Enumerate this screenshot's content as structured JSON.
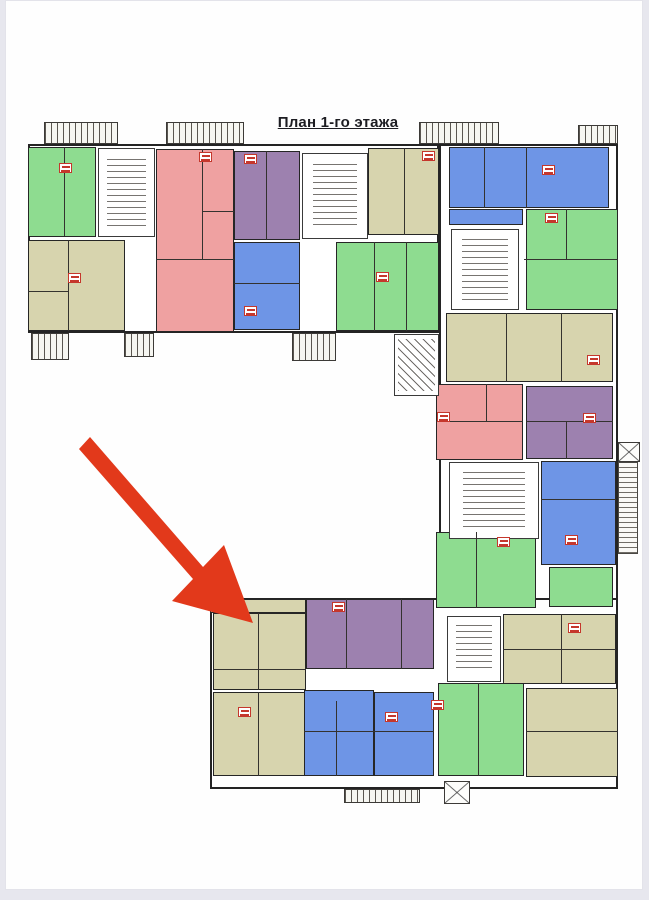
{
  "page": {
    "title": "План 1-го этажа",
    "background": "#fefefe",
    "frame_color": "#e7e7ee"
  },
  "palette": {
    "wall": "#242424",
    "green": "#8edc90",
    "pink": "#efa1a1",
    "purple": "#9d81af",
    "blue": "#6e95e6",
    "olive": "#d7d4ae",
    "arrow": "#e2391b",
    "badge_border": "#c5372c"
  },
  "arrow": {
    "points": "84,436 197,566 218,544 247,622 166,600 187,578 73,448"
  },
  "outlines": [
    {
      "name": "top-wing-outline",
      "x": 22,
      "y": 143,
      "w": 411,
      "h": 189
    },
    {
      "name": "right-wing-outline",
      "x": 433,
      "y": 143,
      "w": 179,
      "h": 469
    },
    {
      "name": "bottom-wing-outline",
      "x": 204,
      "y": 597,
      "w": 408,
      "h": 191
    }
  ],
  "balconies": [
    {
      "name": "balcony-top-1",
      "x": 38,
      "y": 121,
      "w": 74,
      "h": 22,
      "variant": "ladder"
    },
    {
      "name": "balcony-top-2",
      "x": 160,
      "y": 121,
      "w": 78,
      "h": 22,
      "variant": "ladder"
    },
    {
      "name": "balcony-top-3",
      "x": 413,
      "y": 121,
      "w": 80,
      "h": 22,
      "variant": "ladder"
    },
    {
      "name": "balcony-top-4",
      "x": 572,
      "y": 124,
      "w": 40,
      "h": 19,
      "variant": "ladder"
    },
    {
      "name": "entry-stair-left-1",
      "x": 25,
      "y": 332,
      "w": 38,
      "h": 27,
      "variant": "ladder"
    },
    {
      "name": "entry-stair-left-2",
      "x": 118,
      "y": 332,
      "w": 30,
      "h": 24,
      "variant": "ladder"
    },
    {
      "name": "entry-stair-left-3",
      "x": 286,
      "y": 332,
      "w": 44,
      "h": 28,
      "variant": "ladder"
    },
    {
      "name": "entry-stair-bottom",
      "x": 338,
      "y": 788,
      "w": 76,
      "h": 14,
      "variant": "ladder"
    },
    {
      "name": "shaft-bottom",
      "x": 438,
      "y": 780,
      "w": 26,
      "h": 23,
      "variant": "xbox"
    },
    {
      "name": "shaft-right",
      "x": 612,
      "y": 441,
      "w": 22,
      "h": 20,
      "variant": "xbox"
    },
    {
      "name": "balcony-right-strip",
      "x": 612,
      "y": 461,
      "w": 20,
      "h": 92,
      "variant": "vlines"
    }
  ],
  "blocks": [
    {
      "name": "apartment-green-1",
      "x": 22,
      "y": 146,
      "w": 68,
      "h": 90,
      "color": "green"
    },
    {
      "name": "apartment-olive-1",
      "x": 22,
      "y": 239,
      "w": 97,
      "h": 91,
      "color": "olive"
    },
    {
      "name": "apartment-pink-1",
      "x": 150,
      "y": 148,
      "w": 78,
      "h": 183,
      "color": "pink"
    },
    {
      "name": "apartment-purple-1",
      "x": 228,
      "y": 150,
      "w": 66,
      "h": 89,
      "color": "purple"
    },
    {
      "name": "apartment-blue-1",
      "x": 228,
      "y": 241,
      "w": 66,
      "h": 88,
      "color": "blue"
    },
    {
      "name": "apartment-olive-2",
      "x": 362,
      "y": 147,
      "w": 71,
      "h": 87,
      "color": "olive"
    },
    {
      "name": "apartment-green-2",
      "x": 330,
      "y": 241,
      "w": 103,
      "h": 89,
      "color": "green"
    },
    {
      "name": "apartment-blue-2",
      "x": 443,
      "y": 146,
      "w": 160,
      "h": 61,
      "color": "blue"
    },
    {
      "name": "apartment-blue-2-annex",
      "x": 443,
      "y": 208,
      "w": 74,
      "h": 16,
      "color": "blue"
    },
    {
      "name": "apartment-green-3",
      "x": 520,
      "y": 208,
      "w": 92,
      "h": 101,
      "color": "green"
    },
    {
      "name": "apartment-olive-3",
      "x": 440,
      "y": 312,
      "w": 167,
      "h": 69,
      "color": "olive"
    },
    {
      "name": "apartment-pink-2",
      "x": 430,
      "y": 383,
      "w": 87,
      "h": 76,
      "color": "pink"
    },
    {
      "name": "apartment-purple-2",
      "x": 520,
      "y": 385,
      "w": 87,
      "h": 73,
      "color": "purple"
    },
    {
      "name": "apartment-blue-3",
      "x": 535,
      "y": 460,
      "w": 75,
      "h": 104,
      "color": "blue"
    },
    {
      "name": "apartment-green-4",
      "x": 543,
      "y": 566,
      "w": 64,
      "h": 40,
      "color": "green"
    },
    {
      "name": "apartment-green-5",
      "x": 430,
      "y": 531,
      "w": 100,
      "h": 76,
      "color": "green"
    },
    {
      "name": "balcony-row-olive",
      "x": 204,
      "y": 598,
      "w": 96,
      "h": 14,
      "color": "olive"
    },
    {
      "name": "apartment-olive-target",
      "x": 207,
      "y": 612,
      "w": 93,
      "h": 77,
      "color": "olive"
    },
    {
      "name": "apartment-purple-3",
      "x": 300,
      "y": 598,
      "w": 128,
      "h": 70,
      "color": "purple"
    },
    {
      "name": "apartment-olive-4",
      "x": 207,
      "y": 691,
      "w": 93,
      "h": 84,
      "color": "olive"
    },
    {
      "name": "apartment-blue-4",
      "x": 298,
      "y": 689,
      "w": 70,
      "h": 86,
      "color": "blue"
    },
    {
      "name": "apartment-blue-5",
      "x": 368,
      "y": 691,
      "w": 60,
      "h": 84,
      "color": "blue"
    },
    {
      "name": "apartment-green-6",
      "x": 432,
      "y": 682,
      "w": 86,
      "h": 93,
      "color": "green"
    },
    {
      "name": "apartment-olive-5",
      "x": 520,
      "y": 687,
      "w": 92,
      "h": 89,
      "color": "olive"
    },
    {
      "name": "apartment-olive-6",
      "x": 497,
      "y": 613,
      "w": 113,
      "h": 70,
      "color": "olive"
    }
  ],
  "cores": [
    {
      "name": "stair-core-1",
      "x": 92,
      "y": 147,
      "w": 57,
      "h": 89,
      "pattern": "stairs"
    },
    {
      "name": "stair-core-2",
      "x": 296,
      "y": 152,
      "w": 66,
      "h": 86,
      "pattern": "stairs"
    },
    {
      "name": "stair-core-3",
      "x": 445,
      "y": 228,
      "w": 68,
      "h": 81,
      "pattern": "stairs"
    },
    {
      "name": "stair-core-4",
      "x": 443,
      "y": 461,
      "w": 90,
      "h": 77,
      "pattern": "stairs"
    },
    {
      "name": "stair-core-5",
      "x": 441,
      "y": 615,
      "w": 54,
      "h": 66,
      "pattern": "stairs"
    },
    {
      "name": "stair-connector",
      "x": 388,
      "y": 333,
      "w": 45,
      "h": 62,
      "pattern": "diag"
    }
  ],
  "dividers": [
    {
      "x": 58,
      "y": 146,
      "w": 1,
      "h": 89
    },
    {
      "x": 62,
      "y": 239,
      "w": 1,
      "h": 91
    },
    {
      "x": 22,
      "y": 290,
      "w": 40,
      "h": 1
    },
    {
      "x": 196,
      "y": 148,
      "w": 1,
      "h": 110
    },
    {
      "x": 150,
      "y": 258,
      "w": 78,
      "h": 1
    },
    {
      "x": 196,
      "y": 210,
      "w": 32,
      "h": 1
    },
    {
      "x": 260,
      "y": 150,
      "w": 1,
      "h": 89
    },
    {
      "x": 228,
      "y": 282,
      "w": 66,
      "h": 1
    },
    {
      "x": 398,
      "y": 147,
      "w": 1,
      "h": 87
    },
    {
      "x": 368,
      "y": 241,
      "w": 1,
      "h": 89
    },
    {
      "x": 400,
      "y": 241,
      "w": 1,
      "h": 89
    },
    {
      "x": 478,
      "y": 146,
      "w": 1,
      "h": 61
    },
    {
      "x": 520,
      "y": 146,
      "w": 1,
      "h": 61
    },
    {
      "x": 518,
      "y": 258,
      "w": 94,
      "h": 1
    },
    {
      "x": 560,
      "y": 208,
      "w": 1,
      "h": 50
    },
    {
      "x": 500,
      "y": 312,
      "w": 1,
      "h": 69
    },
    {
      "x": 555,
      "y": 312,
      "w": 1,
      "h": 69
    },
    {
      "x": 430,
      "y": 420,
      "w": 87,
      "h": 1
    },
    {
      "x": 480,
      "y": 383,
      "w": 1,
      "h": 37
    },
    {
      "x": 520,
      "y": 420,
      "w": 87,
      "h": 1
    },
    {
      "x": 560,
      "y": 420,
      "w": 1,
      "h": 38
    },
    {
      "x": 535,
      "y": 498,
      "w": 75,
      "h": 1
    },
    {
      "x": 470,
      "y": 531,
      "w": 1,
      "h": 76
    },
    {
      "x": 252,
      "y": 612,
      "w": 1,
      "h": 77
    },
    {
      "x": 207,
      "y": 668,
      "w": 93,
      "h": 1
    },
    {
      "x": 340,
      "y": 598,
      "w": 1,
      "h": 70
    },
    {
      "x": 395,
      "y": 598,
      "w": 1,
      "h": 70
    },
    {
      "x": 252,
      "y": 691,
      "w": 1,
      "h": 84
    },
    {
      "x": 330,
      "y": 700,
      "w": 1,
      "h": 75
    },
    {
      "x": 298,
      "y": 730,
      "w": 70,
      "h": 1
    },
    {
      "x": 368,
      "y": 730,
      "w": 60,
      "h": 1
    },
    {
      "x": 472,
      "y": 682,
      "w": 1,
      "h": 93
    },
    {
      "x": 520,
      "y": 730,
      "w": 92,
      "h": 1
    },
    {
      "x": 555,
      "y": 613,
      "w": 1,
      "h": 70
    },
    {
      "x": 497,
      "y": 648,
      "w": 113,
      "h": 1
    }
  ],
  "badges": [
    {
      "name": "unit-label-badge",
      "x": 53,
      "y": 162
    },
    {
      "name": "unit-label-badge",
      "x": 62,
      "y": 272
    },
    {
      "name": "unit-label-badge",
      "x": 193,
      "y": 151
    },
    {
      "name": "unit-label-badge",
      "x": 238,
      "y": 153
    },
    {
      "name": "unit-label-badge",
      "x": 238,
      "y": 305
    },
    {
      "name": "unit-label-badge",
      "x": 416,
      "y": 150
    },
    {
      "name": "unit-label-badge",
      "x": 370,
      "y": 271
    },
    {
      "name": "unit-label-badge",
      "x": 536,
      "y": 164
    },
    {
      "name": "unit-label-badge",
      "x": 539,
      "y": 212
    },
    {
      "name": "unit-label-badge",
      "x": 581,
      "y": 354
    },
    {
      "name": "unit-label-badge",
      "x": 431,
      "y": 411
    },
    {
      "name": "unit-label-badge",
      "x": 577,
      "y": 412
    },
    {
      "name": "unit-label-badge",
      "x": 559,
      "y": 534
    },
    {
      "name": "unit-label-badge",
      "x": 491,
      "y": 536
    },
    {
      "name": "unit-label-badge",
      "x": 326,
      "y": 601
    },
    {
      "name": "unit-label-badge",
      "x": 232,
      "y": 706
    },
    {
      "name": "unit-label-badge",
      "x": 379,
      "y": 711
    },
    {
      "name": "unit-label-badge",
      "x": 425,
      "y": 699
    },
    {
      "name": "unit-label-badge",
      "x": 562,
      "y": 622
    }
  ]
}
